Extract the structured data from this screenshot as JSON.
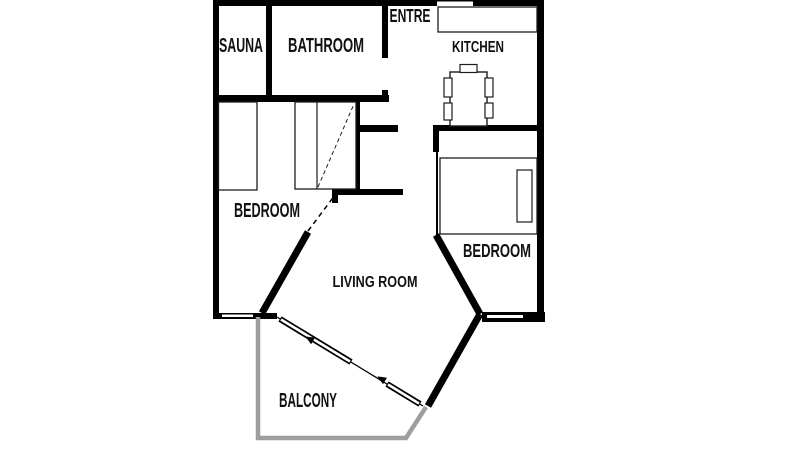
{
  "app": {
    "type": "apartment-floor-plan",
    "background": "#ffffff"
  },
  "colors": {
    "wall": "#000000",
    "furniture_outline": "#1c1c1c",
    "balcony_outline": "#9e9e9e",
    "label_text": "#111111"
  },
  "rooms": {
    "sauna": {
      "label": "SAUNA"
    },
    "bathroom": {
      "label": "BATHROOM"
    },
    "entre": {
      "label": "ENTRE"
    },
    "kitchen": {
      "label": "KITCHEN"
    },
    "bedroom_left": {
      "label": "BEDROOM"
    },
    "living_room": {
      "label": "LIVING ROOM"
    },
    "bedroom_right": {
      "label": "BEDROOM"
    },
    "balcony": {
      "label": "BALCONY"
    }
  },
  "furniture": [
    "single-bed",
    "wardrobe-with-mirror-door",
    "kitchen-counter",
    "dining-table",
    "chair",
    "double-bed",
    "sliding-balcony-door",
    "window"
  ]
}
